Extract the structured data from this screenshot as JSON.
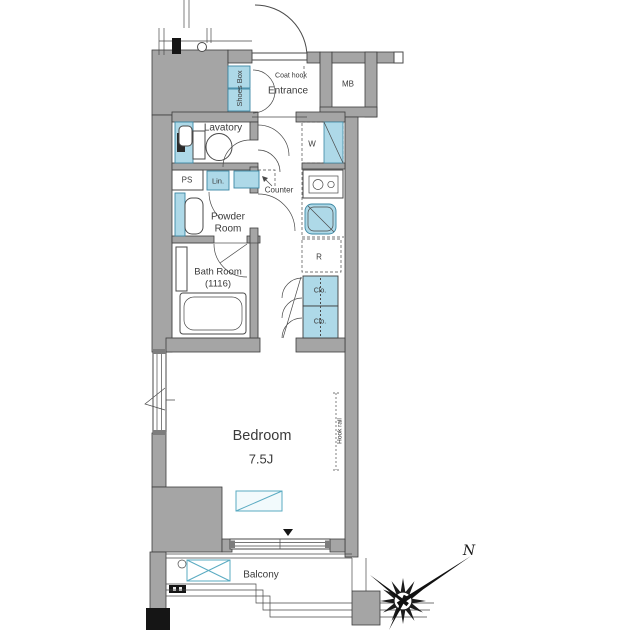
{
  "title": "apartment-floor-plan",
  "rooms": {
    "entrance": {
      "label": "Entrance"
    },
    "lavatory": {
      "label": "Lavatory"
    },
    "powder_room": {
      "line1": "Powder",
      "line2": "Room"
    },
    "bath_room": {
      "line1": "Bath Room",
      "line2": "(1116)"
    },
    "bedroom": {
      "label": "Bedroom",
      "size": "7.5J"
    },
    "balcony": {
      "label": "Balcony"
    }
  },
  "fixtures": {
    "coat_hook": "Coat hook",
    "shoes_box": "Shoes Box",
    "meter_box": "MB",
    "washer": "W",
    "pipe_space": "PS",
    "linen": "Lin.",
    "counter": "Counter",
    "refrigerator": "R",
    "closet_upper": "Clo.",
    "closet_lower": "Clo.",
    "hook_rail": "Hook rail"
  },
  "compass": {
    "north": "N"
  },
  "colors": {
    "wall_gray": "#a5a5a5",
    "fixture_blue": "#aed9e8",
    "fixture_blue_stroke": "#3b87a3",
    "accent_teal": "#5aabc2",
    "line": "#4a4a4a",
    "text": "#3a3a3a",
    "black": "#151515"
  }
}
